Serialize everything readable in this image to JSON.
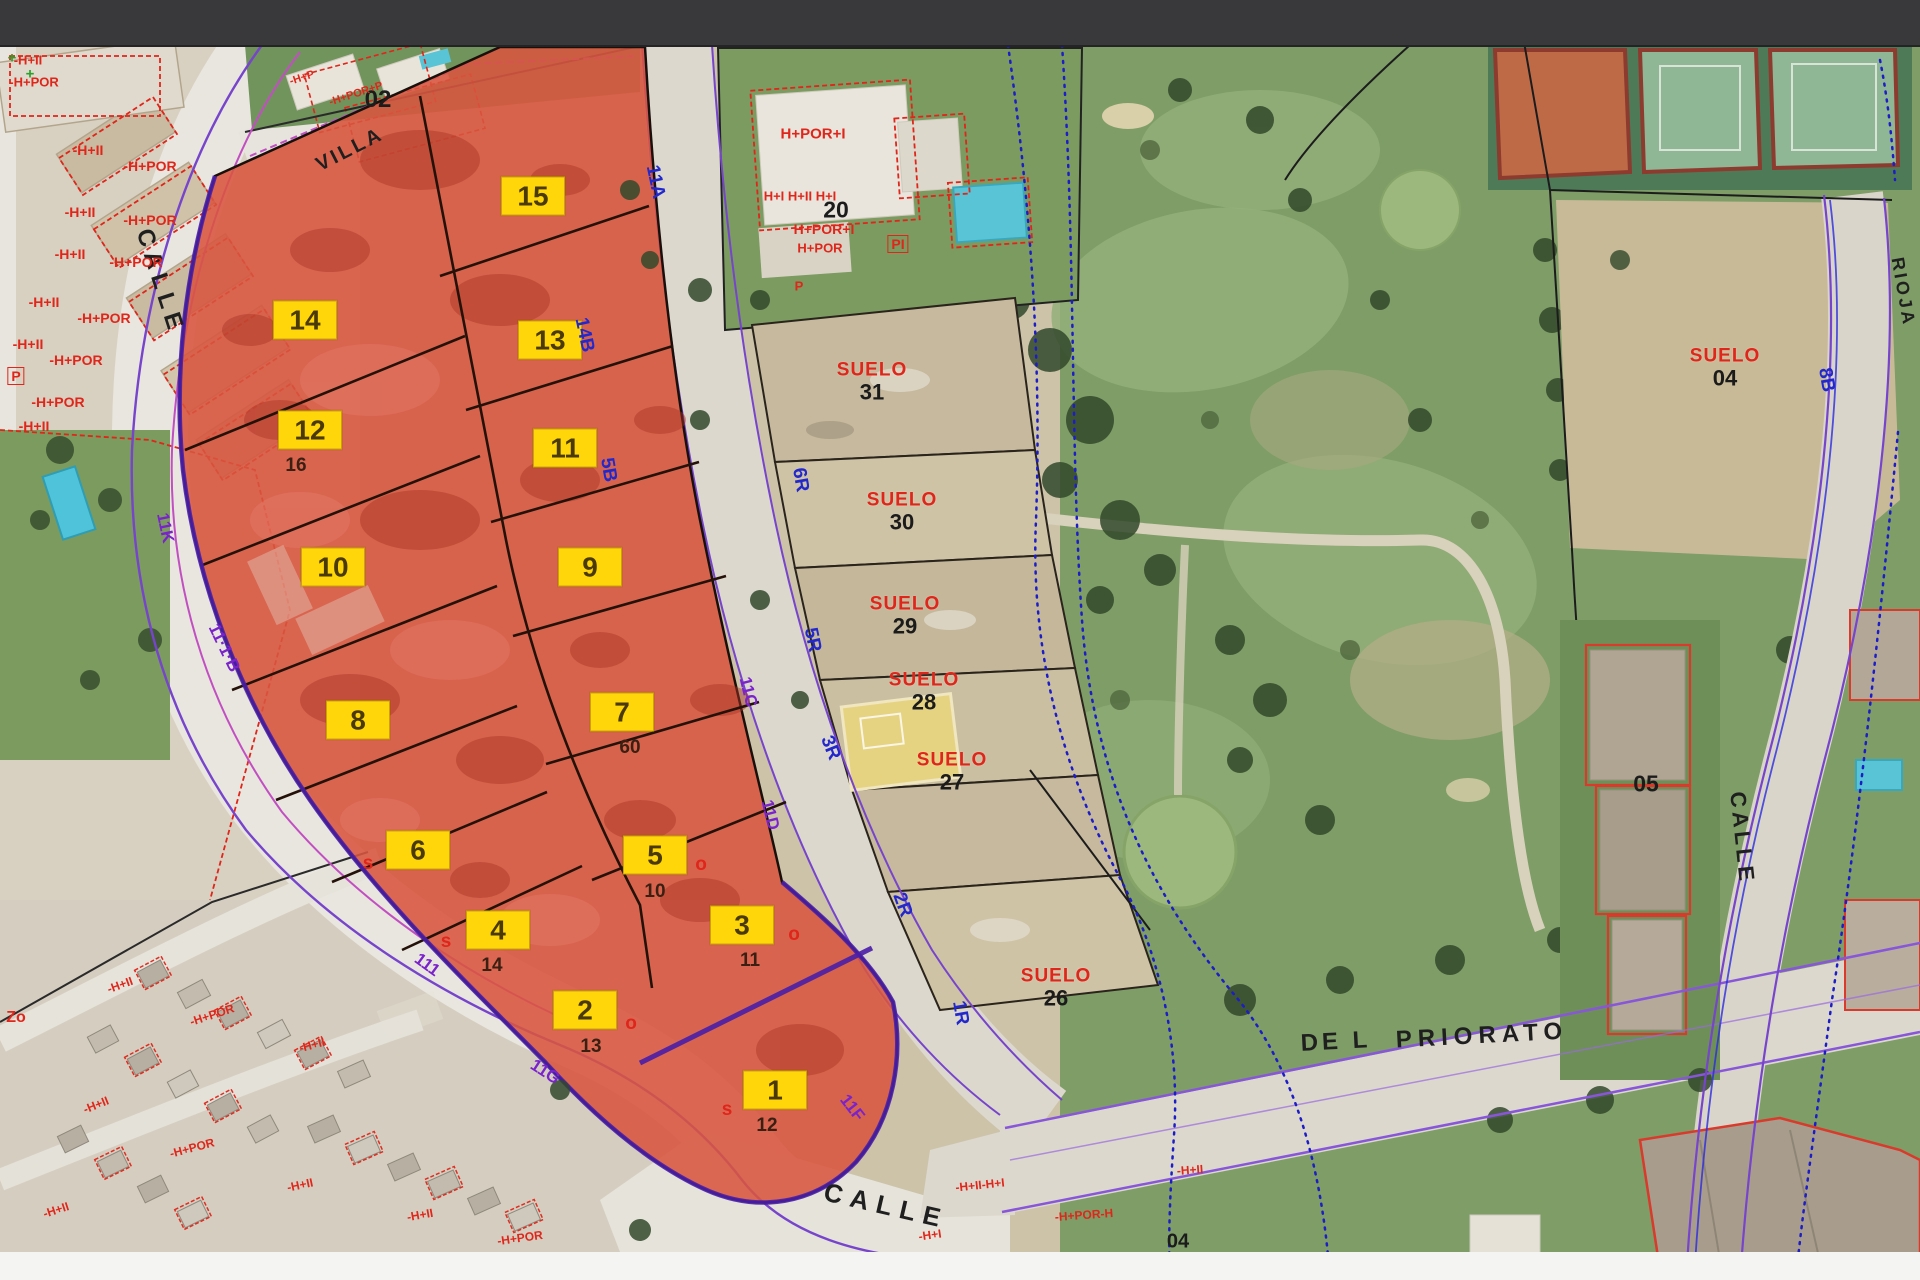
{
  "screen": {
    "width": 1920,
    "height": 1280,
    "top_bar_color": "#39393b",
    "footer_color": "#f4f4f2"
  },
  "map": {
    "type": "aerial-cadastral-overlay",
    "colors": {
      "highlight_fill": "#d8553f",
      "highlight_outline": "#4a1fa8",
      "parcel_label_bg": "#ffd60a",
      "suelo_red": "#e0251a",
      "code_blue": "#2228cc",
      "code_purple": "#7a22cc",
      "road_line_purple": "#7744cc",
      "road_line_magenta": "#c24fc2",
      "gps_dotted_blue": "#1d1dc8"
    },
    "parcels": [
      {
        "num": "1",
        "x": 775,
        "y": 1090,
        "notes": [
          {
            "text": "s",
            "color": "red",
            "dx": -48,
            "dy": 20
          },
          {
            "text": "12",
            "color": "dark",
            "dx": -8,
            "dy": 36
          }
        ]
      },
      {
        "num": "2",
        "x": 585,
        "y": 1010,
        "notes": [
          {
            "text": "o",
            "color": "red",
            "dx": 46,
            "dy": 14
          },
          {
            "text": "13",
            "color": "dark",
            "dx": 6,
            "dy": 37
          }
        ]
      },
      {
        "num": "3",
        "x": 742,
        "y": 925,
        "notes": [
          {
            "text": "o",
            "color": "red",
            "dx": 52,
            "dy": 10
          },
          {
            "text": "11",
            "color": "dark",
            "dx": 8,
            "dy": 36
          }
        ]
      },
      {
        "num": "4",
        "x": 498,
        "y": 930,
        "notes": [
          {
            "text": "s",
            "color": "red",
            "dx": -52,
            "dy": 12
          },
          {
            "text": "14",
            "color": "dark",
            "dx": -6,
            "dy": 36
          }
        ]
      },
      {
        "num": "5",
        "x": 655,
        "y": 855,
        "notes": [
          {
            "text": "o",
            "color": "red",
            "dx": 46,
            "dy": 10
          },
          {
            "text": "10",
            "color": "dark",
            "dx": 0,
            "dy": 37
          }
        ]
      },
      {
        "num": "6",
        "x": 418,
        "y": 850,
        "notes": [
          {
            "text": "s",
            "color": "red",
            "dx": -50,
            "dy": 14
          }
        ]
      },
      {
        "num": "7",
        "x": 622,
        "y": 712,
        "notes": [
          {
            "text": "60",
            "color": "dark",
            "dx": 8,
            "dy": 36
          }
        ]
      },
      {
        "num": "8",
        "x": 358,
        "y": 720,
        "notes": []
      },
      {
        "num": "9",
        "x": 590,
        "y": 567,
        "notes": []
      },
      {
        "num": "10",
        "x": 333,
        "y": 567,
        "notes": []
      },
      {
        "num": "11",
        "x": 565,
        "y": 448,
        "notes": []
      },
      {
        "num": "12",
        "x": 310,
        "y": 430,
        "notes": [
          {
            "text": "16",
            "color": "dark",
            "dx": -14,
            "dy": 36
          }
        ]
      },
      {
        "num": "13",
        "x": 550,
        "y": 340,
        "notes": []
      },
      {
        "num": "14",
        "x": 305,
        "y": 320,
        "notes": []
      },
      {
        "num": "15",
        "x": 533,
        "y": 196,
        "notes": []
      }
    ],
    "suelo_labels": [
      {
        "word": "SUELO",
        "num": "31",
        "x": 872,
        "y": 382
      },
      {
        "word": "SUELO",
        "num": "30",
        "x": 902,
        "y": 512
      },
      {
        "word": "SUELO",
        "num": "29",
        "x": 905,
        "y": 616
      },
      {
        "word": "SUELO",
        "num": "28",
        "x": 924,
        "y": 692
      },
      {
        "word": "SUELO",
        "num": "27",
        "x": 952,
        "y": 772
      },
      {
        "word": "SUELO",
        "num": "26",
        "x": 1056,
        "y": 988
      },
      {
        "word": "SUELO",
        "num": "04",
        "x": 1725,
        "y": 368
      }
    ],
    "street_names": [
      {
        "text": "CALLE",
        "x": 160,
        "y": 282,
        "rot": 72,
        "size": 24,
        "ls": 6
      },
      {
        "text": "VILLA",
        "x": 350,
        "y": 150,
        "rot": -27,
        "size": 20,
        "ls": 3
      },
      {
        "text": "CALLE",
        "x": 886,
        "y": 1206,
        "rot": 13,
        "size": 26,
        "ls": 8
      },
      {
        "text": "DE L",
        "x": 1336,
        "y": 1042,
        "rot": -3,
        "size": 24,
        "ls": 4
      },
      {
        "text": "PRIORATO",
        "x": 1482,
        "y": 1036,
        "rot": -3,
        "size": 24,
        "ls": 6
      },
      {
        "text": "CALLE",
        "x": 1742,
        "y": 838,
        "rot": 84,
        "size": 22,
        "ls": 4
      },
      {
        "text": "RIOJA",
        "x": 1903,
        "y": 292,
        "rot": 80,
        "size": 18,
        "ls": 3
      }
    ],
    "street_codes": [
      {
        "text": "11A",
        "x": 655,
        "y": 182,
        "rot": 78
      },
      {
        "text": "14B",
        "x": 584,
        "y": 335,
        "rot": 78
      },
      {
        "text": "5B",
        "x": 608,
        "y": 470,
        "rot": 80
      },
      {
        "text": "6R",
        "x": 800,
        "y": 480,
        "rot": 80
      },
      {
        "text": "5R",
        "x": 812,
        "y": 640,
        "rot": 78
      },
      {
        "text": "3R",
        "x": 830,
        "y": 748,
        "rot": 68
      },
      {
        "text": "2R",
        "x": 902,
        "y": 905,
        "rot": 70
      },
      {
        "text": "1R",
        "x": 960,
        "y": 1013,
        "rot": 80
      },
      {
        "text": "8B",
        "x": 1826,
        "y": 380,
        "rot": 80
      }
    ],
    "curb_codes": [
      {
        "text": "11K",
        "x": 165,
        "y": 528,
        "rot": 78
      },
      {
        "text": "11·1·B",
        "x": 224,
        "y": 648,
        "rot": 64
      },
      {
        "text": "111",
        "x": 427,
        "y": 965,
        "rot": 36
      },
      {
        "text": "11G",
        "x": 545,
        "y": 1072,
        "rot": 33
      },
      {
        "text": "11F",
        "x": 852,
        "y": 1108,
        "rot": 52
      },
      {
        "text": "11C",
        "x": 748,
        "y": 692,
        "rot": 76
      },
      {
        "text": "11D",
        "x": 770,
        "y": 815,
        "rot": 76
      }
    ],
    "annotations": [
      {
        "text": "-H+II",
        "x": 28,
        "y": 60,
        "color": "red",
        "size": 13,
        "rot": 0
      },
      {
        "text": "-H+POR",
        "x": 34,
        "y": 82,
        "color": "red",
        "size": 13,
        "rot": 0
      },
      {
        "text": "-H+II",
        "x": 88,
        "y": 150,
        "color": "red",
        "size": 14,
        "rot": 0
      },
      {
        "text": "-H+POR",
        "x": 150,
        "y": 166,
        "color": "red",
        "size": 14,
        "rot": 0
      },
      {
        "text": "-H+II",
        "x": 80,
        "y": 212,
        "color": "red",
        "size": 14,
        "rot": 0
      },
      {
        "text": "-H+POR",
        "x": 150,
        "y": 220,
        "color": "red",
        "size": 14,
        "rot": 0
      },
      {
        "text": "-H+II",
        "x": 70,
        "y": 254,
        "color": "red",
        "size": 14,
        "rot": 0
      },
      {
        "text": "-H+POR",
        "x": 136,
        "y": 262,
        "color": "red",
        "size": 14,
        "rot": 0
      },
      {
        "text": "-H+II",
        "x": 44,
        "y": 302,
        "color": "red",
        "size": 14,
        "rot": 0
      },
      {
        "text": "-H+POR",
        "x": 104,
        "y": 318,
        "color": "red",
        "size": 14,
        "rot": 0
      },
      {
        "text": "-H+II",
        "x": 28,
        "y": 344,
        "color": "red",
        "size": 14,
        "rot": 0
      },
      {
        "text": "-H+POR",
        "x": 76,
        "y": 360,
        "color": "red",
        "size": 14,
        "rot": 0
      },
      {
        "text": "-H+POR",
        "x": 58,
        "y": 402,
        "color": "red",
        "size": 14,
        "rot": 0
      },
      {
        "text": "-H+II",
        "x": 34,
        "y": 426,
        "color": "red",
        "size": 14,
        "rot": 0
      },
      {
        "text": "P",
        "x": 16,
        "y": 376,
        "color": "red",
        "size": 14,
        "rot": 0,
        "boxed": true
      },
      {
        "text": "Zo",
        "x": 16,
        "y": 1018,
        "color": "red",
        "size": 16,
        "rot": 0
      },
      {
        "text": "02",
        "x": 378,
        "y": 100,
        "color": "black",
        "size": 24,
        "rot": 0
      },
      {
        "text": "-H+P",
        "x": 302,
        "y": 78,
        "color": "red",
        "size": 11,
        "rot": -18
      },
      {
        "text": "-H+POR+P",
        "x": 356,
        "y": 94,
        "color": "red",
        "size": 11,
        "rot": -18
      },
      {
        "text": "H+POR+I",
        "x": 813,
        "y": 134,
        "color": "red",
        "size": 15,
        "rot": 0
      },
      {
        "text": "H+I  H+II  H+I",
        "x": 800,
        "y": 196,
        "color": "red",
        "size": 13,
        "rot": 0
      },
      {
        "text": "20",
        "x": 836,
        "y": 210,
        "color": "black",
        "size": 23,
        "rot": 0
      },
      {
        "text": "H+POR+I",
        "x": 824,
        "y": 229,
        "color": "red",
        "size": 14,
        "rot": 0
      },
      {
        "text": "H+POR",
        "x": 820,
        "y": 248,
        "color": "red",
        "size": 13,
        "rot": 0
      },
      {
        "text": "PI",
        "x": 898,
        "y": 244,
        "color": "red",
        "size": 14,
        "rot": 0,
        "boxed": true
      },
      {
        "text": "P",
        "x": 799,
        "y": 286,
        "color": "red",
        "size": 13,
        "rot": 0
      },
      {
        "text": "05",
        "x": 1646,
        "y": 784,
        "color": "black",
        "size": 23,
        "rot": 0
      },
      {
        "text": "04",
        "x": 1178,
        "y": 1242,
        "color": "black",
        "size": 20,
        "rot": 0
      },
      {
        "text": "-H+II",
        "x": 120,
        "y": 985,
        "color": "red",
        "size": 12,
        "rot": -20
      },
      {
        "text": "-H+POR",
        "x": 212,
        "y": 1015,
        "color": "red",
        "size": 12,
        "rot": -18
      },
      {
        "text": "-H+II",
        "x": 312,
        "y": 1045,
        "color": "red",
        "size": 12,
        "rot": -15
      },
      {
        "text": "-H+II",
        "x": 96,
        "y": 1105,
        "color": "red",
        "size": 12,
        "rot": -22
      },
      {
        "text": "-H+POR",
        "x": 192,
        "y": 1148,
        "color": "red",
        "size": 12,
        "rot": -15
      },
      {
        "text": "-H+II",
        "x": 300,
        "y": 1185,
        "color": "red",
        "size": 12,
        "rot": -12
      },
      {
        "text": "-H+II",
        "x": 420,
        "y": 1215,
        "color": "red",
        "size": 12,
        "rot": -10
      },
      {
        "text": "-H+POR",
        "x": 520,
        "y": 1238,
        "color": "red",
        "size": 12,
        "rot": -8
      },
      {
        "text": "-H+II",
        "x": 56,
        "y": 1210,
        "color": "red",
        "size": 12,
        "rot": -18
      },
      {
        "text": "-H+II-H+I",
        "x": 980,
        "y": 1185,
        "color": "red",
        "size": 12,
        "rot": -6
      },
      {
        "text": "-H+POR-H",
        "x": 1084,
        "y": 1215,
        "color": "red",
        "size": 12,
        "rot": -4
      },
      {
        "text": "-H+II",
        "x": 1190,
        "y": 1170,
        "color": "red",
        "size": 12,
        "rot": -4
      },
      {
        "text": "-H+I",
        "x": 930,
        "y": 1235,
        "color": "red",
        "size": 12,
        "rot": -8
      },
      {
        "text": "+",
        "x": 12,
        "y": 58,
        "color": "green",
        "size": 15,
        "rot": 0
      },
      {
        "text": "+",
        "x": 30,
        "y": 74,
        "color": "green",
        "size": 15,
        "rot": 0
      }
    ]
  }
}
